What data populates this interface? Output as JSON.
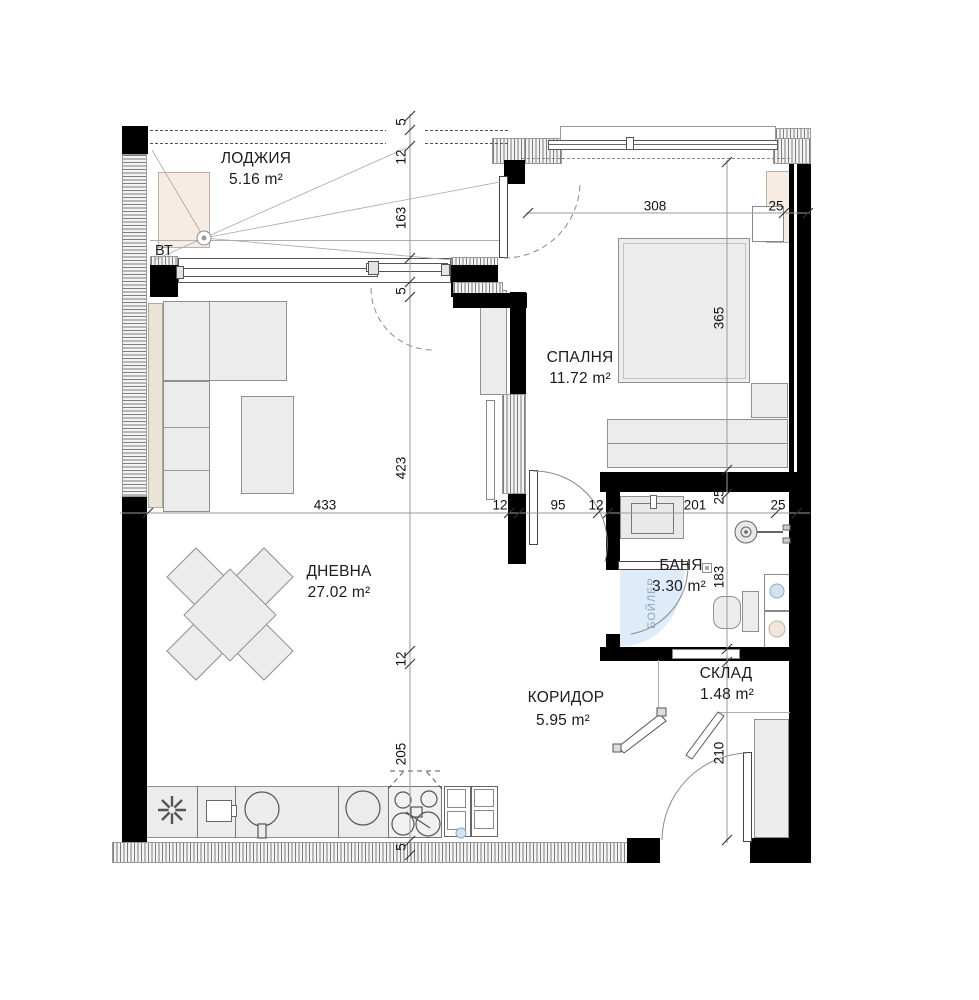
{
  "rooms": {
    "loggia": {
      "name": "ЛОДЖИЯ",
      "area": "5.16 m²"
    },
    "bedroom": {
      "name": "СПАЛНЯ",
      "area": "11.72 m²"
    },
    "living": {
      "name": "ДНЕВНА",
      "area": "27.02 m²"
    },
    "bath": {
      "name": "БАНЯ",
      "area": "3.30 m²"
    },
    "corridor": {
      "name": "КОРИДОР",
      "area": "5.95 m²"
    },
    "storage": {
      "name": "СКЛАД",
      "area": "1.48 m²"
    }
  },
  "labels": {
    "vent": "ВТ",
    "boiler": "БОЙЛЕР"
  },
  "dims": {
    "v_left": [
      "5",
      "12",
      "163",
      "5",
      "423",
      "12",
      "205",
      "5"
    ],
    "h_main": [
      "433",
      "12",
      "95",
      "12",
      "201",
      "25"
    ],
    "h_bedroom": [
      "308",
      "25"
    ],
    "v_right": [
      "365",
      "25",
      "183",
      "210"
    ]
  },
  "colors": {
    "wall": "#000000",
    "furniture": "#ececec",
    "beige": "#f6ece3",
    "boiler_blue": "#d9e8f6"
  }
}
